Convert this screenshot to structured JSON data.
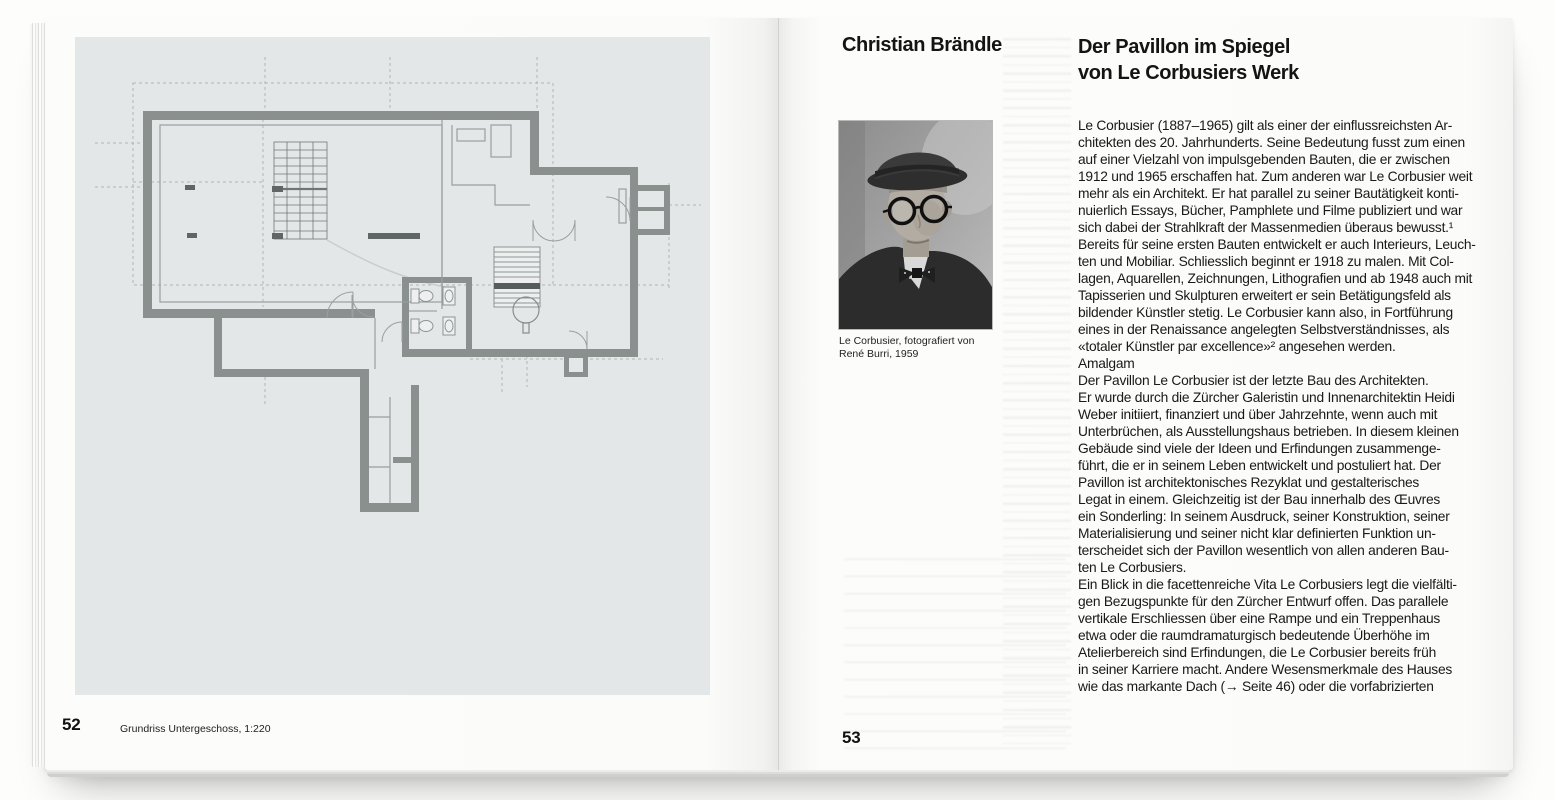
{
  "colors": {
    "paper": "#fbfbfa",
    "plan_background": "#e4e7e8",
    "plan_wall_gray": "#8a908e",
    "plan_line_gray": "#98a09f",
    "plan_dashed_gray": "#aeb5b4",
    "text_black": "#191919"
  },
  "left_page": {
    "page_number": "52",
    "caption": "Grundriss Untergeschoss, 1:220"
  },
  "right_page": {
    "page_number": "53",
    "author": "Christian Brändle",
    "title": "Der Pavillon im Spiegel\nvon Le Corbusiers Werk",
    "photo_caption": "Le Corbusier, fotografiert von\nRené Burri, 1959",
    "section_heading": "Amalgam",
    "paragraph_1": "Le Corbusier (1887–1965) gilt als einer der einflussreichsten Ar-\nchitekten des 20. Jahrhunderts. Seine Bedeutung fusst zum einen\nauf einer Vielzahl von impulsgebenden Bauten, die er zwischen\n1912 und 1965 erschaffen hat. Zum anderen war Le Corbusier weit\nmehr als ein Architekt. Er hat parallel zu seiner Bautätigkeit konti-\nnuierlich Essays, Bücher, Pamphlete und Filme publiziert und war\nsich dabei der Strahlkraft der Massenmedien überaus bewusst.¹\nBereits für seine ersten Bauten entwickelt er auch Interieurs, Leuch-\nten und Mobiliar. Schliesslich beginnt er 1918 zu malen. Mit Col-\nlagen, Aquarellen, Zeichnungen, Lithografien und ab 1948 auch mit\nTapisserien und Skulpturen erweitert er sein Betätigungsfeld als\nbildender Künstler stetig. Le Corbusier kann also, in Fortführung\neines in der Renaissance angelegten Selbstverständnisses, als\n«totaler Künstler par excellence»² angesehen werden.",
    "paragraph_2": "Der Pavillon Le Corbusier ist der letzte Bau des Architekten.\nEr wurde durch die Zürcher Galeristin und Innenarchitektin Heidi\nWeber initiiert, finanziert und über Jahrzehnte, wenn auch mit\nUnterbrüchen, als Ausstellungshaus betrieben. In diesem kleinen\nGebäude sind viele der Ideen und Erfindungen zusammenge-\nführt, die er in seinem Leben entwickelt und postuliert hat. Der\nPavillon ist architektonisches Rezyklat und gestalterisches\nLegat in einem. Gleichzeitig ist der Bau innerhalb des Œuvres\nein Sonderling: In seinem Ausdruck, seiner Konstruktion, seiner\nMaterialisierung und seiner nicht klar definierten Funktion un-\nterscheidet sich der Pavillon wesentlich von allen anderen Bau-\nten Le Corbusiers.",
    "paragraph_3": "Ein Blick in die facettenreiche Vita Le Corbusiers legt die vielfälti-\ngen Bezugspunkte für den Zürcher Entwurf offen. Das parallele\nvertikale Erschliessen über eine Rampe und ein Treppenhaus\netwa oder die raumdramaturgisch bedeutende Überhöhe im\nAtelierbereich sind Erfindungen, die Le Corbusier bereits früh\nin seiner Karriere macht. Andere Wesensmerkmale des Hauses\nwie das markante Dach (→ Seite 46) oder die vorfabrizierten"
  }
}
